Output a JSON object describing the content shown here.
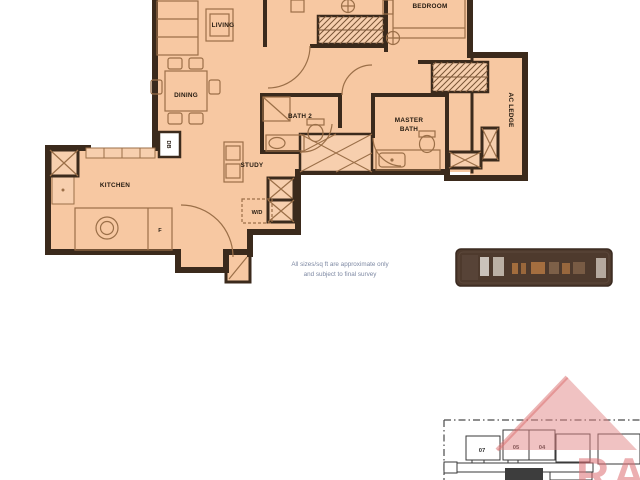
{
  "plan": {
    "labels": {
      "living": "LIVING",
      "dining": "DINING",
      "kitchen": "KITCHEN",
      "bedroom": "BEDROOM",
      "bath2": "BATH 2",
      "master_bath_line1": "MASTER",
      "master_bath_line2": "BATH",
      "study": "STUDY",
      "wd": "W/D",
      "db": "DB",
      "fridge": "F",
      "ac_ledge": "AC LEDGE"
    },
    "colors": {
      "floor": "#f7c8a2",
      "wall": "#3b2a1c",
      "furniture_line": "#9b6f48"
    }
  },
  "disclaimer": {
    "line1": "All sizes/sq ft are approximate only",
    "line2": "and subject to final survey"
  },
  "stamp": {
    "bg_color": "#4e3a2d"
  },
  "key_plan": {
    "units": [
      {
        "label": "07"
      },
      {
        "label": "05"
      },
      {
        "label": "04"
      }
    ]
  },
  "watermark": {
    "letters": "RA",
    "roof_color": "#e28686",
    "letter_color": "#dd6e73"
  }
}
